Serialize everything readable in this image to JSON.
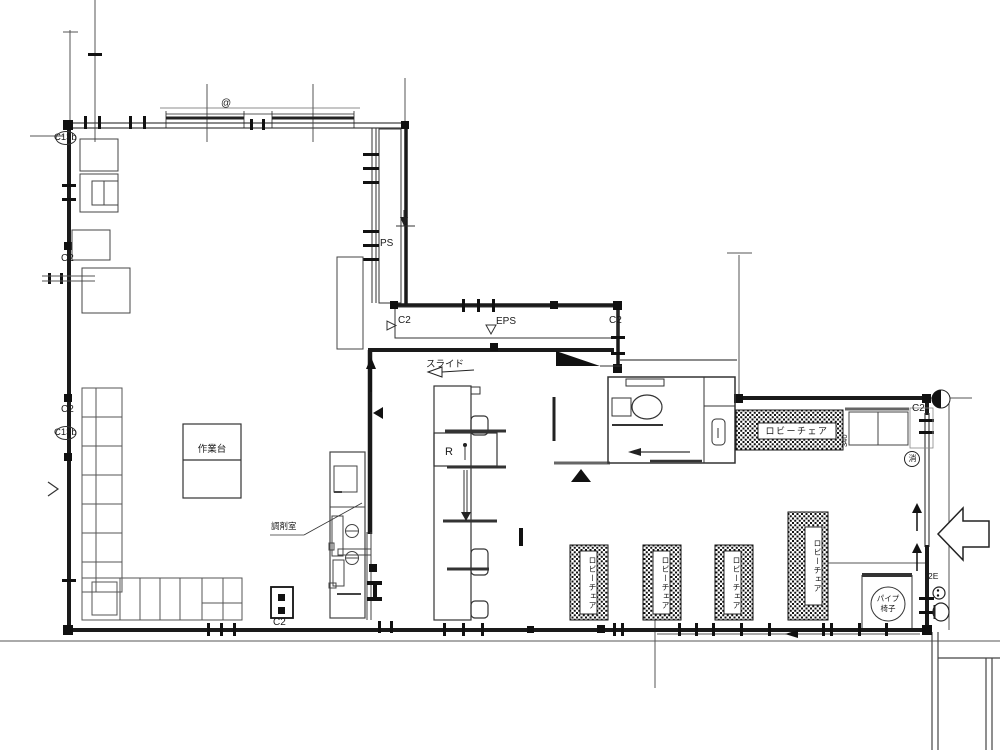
{
  "plan": {
    "grid_labels": {
      "c2": "C2",
      "c13b": "C13b"
    },
    "shafts": {
      "ps": "PS",
      "eps": "EPS"
    },
    "rooms": {
      "dispensing": "調剤室"
    },
    "fixtures": {
      "work_table": "作業台",
      "lobby_chair": "ロビーチェア",
      "reception": "R",
      "slide_door": "スライド",
      "pipe_chair_line1": "パイプ",
      "pipe_chair_line2": "椅子"
    },
    "annotations": {
      "at_mark": "@",
      "dim_340": "340",
      "extinguisher": "消",
      "stair_2e": "2E"
    }
  }
}
